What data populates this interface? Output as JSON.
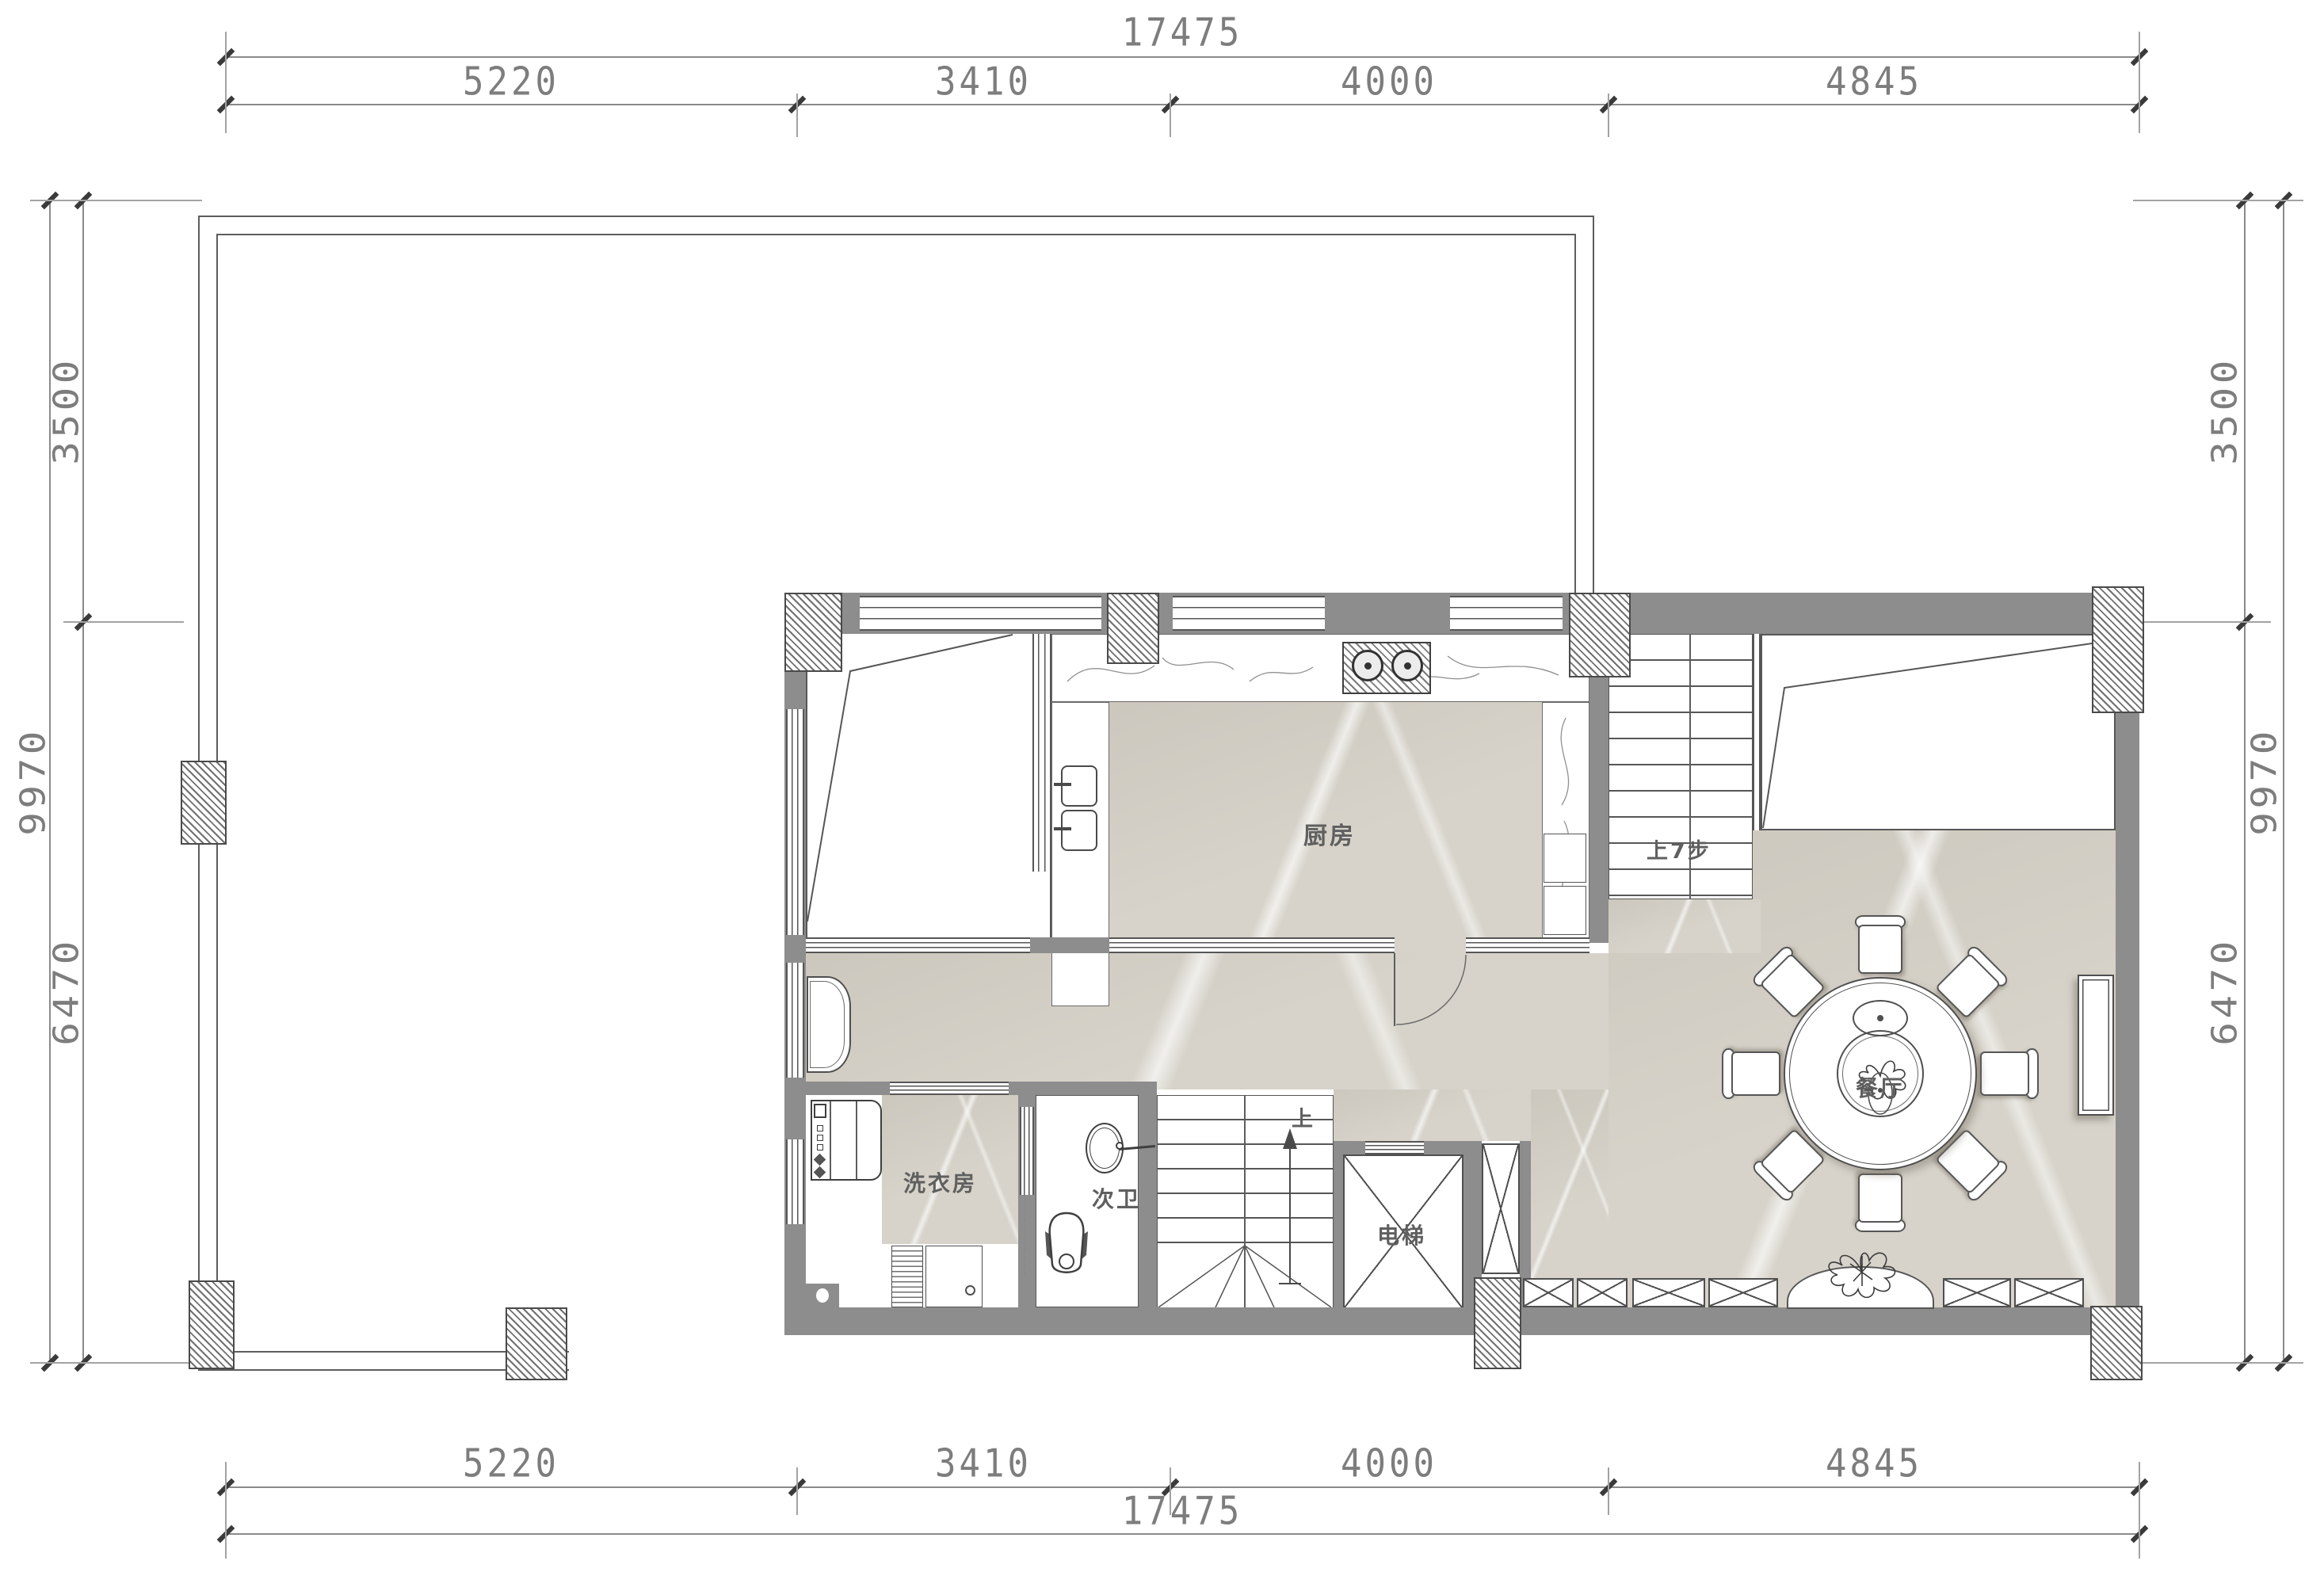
{
  "dimensions": {
    "top": {
      "total": "17475",
      "segments": [
        "5220",
        "3410",
        "4000",
        "4845"
      ]
    },
    "bottom": {
      "total": "17475",
      "segments": [
        "5220",
        "3410",
        "4000",
        "4845"
      ]
    },
    "left": {
      "total": "9970",
      "segments": [
        "3500",
        "6470"
      ]
    },
    "right": {
      "total": "9970",
      "segments": [
        "3500",
        "6470"
      ]
    }
  },
  "rooms": {
    "kitchen": "厨房",
    "dining": "餐厅",
    "laundry": "洗衣房",
    "secondary_bath": "次卫",
    "elevator": "电梯"
  },
  "annotations": {
    "up_seven_steps": "上7步",
    "up": "上"
  },
  "colors": {
    "wall": "#8d8d8d",
    "marble_floor": "#d7d3ca",
    "hatch": "#707070",
    "line": "#555555",
    "dimension_text": "#7d7d7d"
  }
}
